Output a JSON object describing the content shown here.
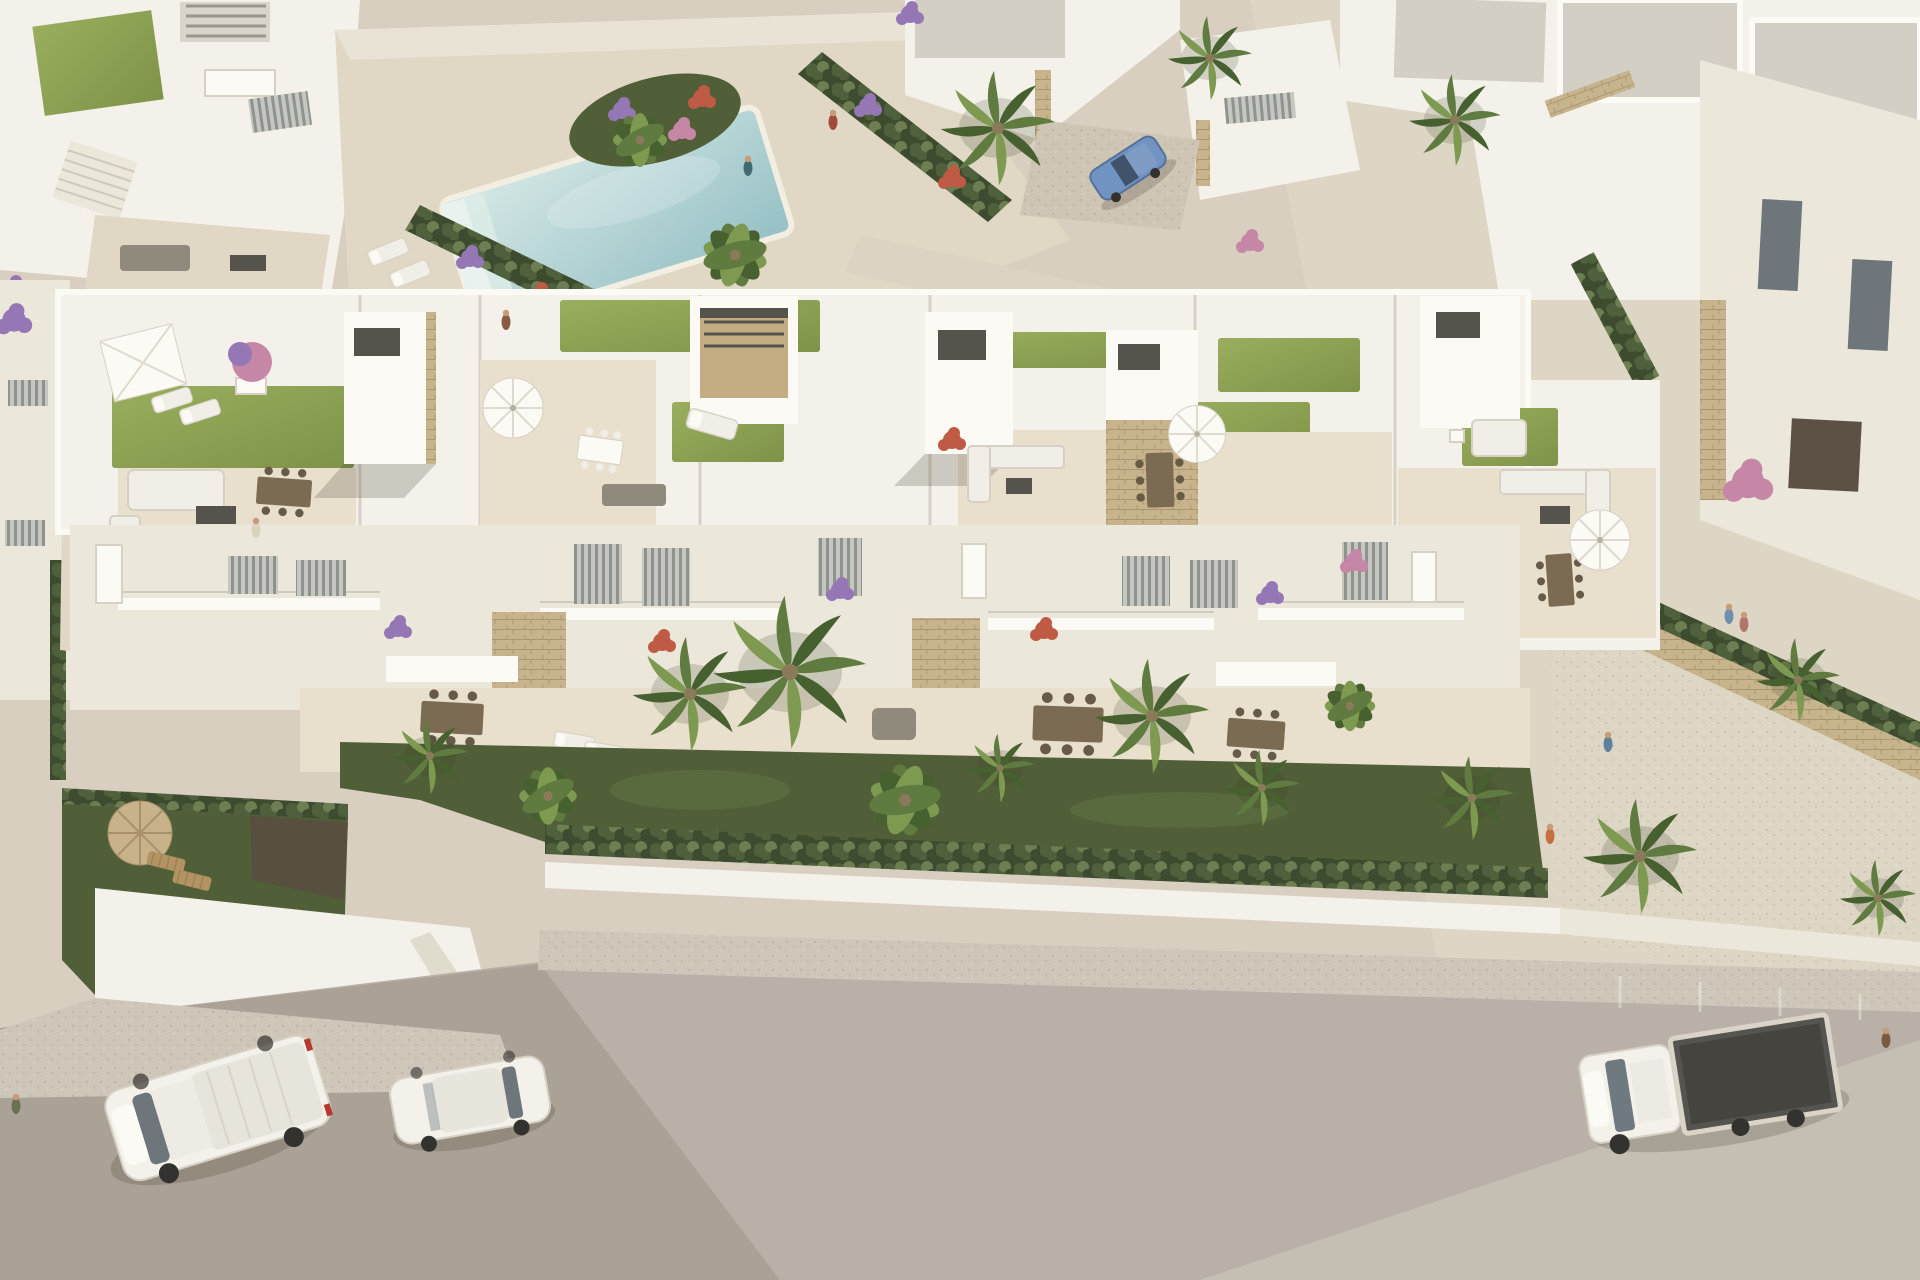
{
  "scene": {
    "title": "Aerial render — white Mediterranean villas with rooftop terraces",
    "description": "Photorealistic CGI bird's-eye view of a new-build residential complex: a long row of white townhouses with landscaped rooftop terraces, private gardens with cypress hedges and palm trees, a communal swimming pool with flower islands among neighbouring villas, and a street in front with parked vehicles.",
    "style": "top-down oblique 3D architectural visualisation, warm afternoon sunlight from upper right, long soft shadows to lower left"
  },
  "palette": {
    "ground": "#d8cfc0",
    "ground-light": "#e7decd",
    "white": "#f3f1e9",
    "white-bright": "#fbfaf4",
    "shade": "#ebe7da",
    "tile": "#e8dfcd",
    "deck": "#e0d7c5",
    "roof": "#d3cfc5",
    "turf1": "#9aae5e",
    "turf2": "#7e9348",
    "lawn": "#6d7f47",
    "lawn-deep": "#515f38",
    "hedge": "#4f603c",
    "hedge-light": "#6d7f52",
    "hedge-dark": "#3d4b2e",
    "palm1": "#5f7b3f",
    "palm2": "#47602f",
    "palm3": "#7d9a50",
    "trunk": "#8b7a5a",
    "pool1": "#d7e9e6",
    "pool2": "#95c0c5",
    "pool-rim": "#f2eee2",
    "road": "#b9b1a7",
    "sidewalk": "#cec6b8",
    "stone": "#c8b48c",
    "stone-dark": "#ab9772",
    "wood": "#b39362",
    "furn": "#8f8a7c",
    "furn-dark": "#55534c",
    "cushion": "#f0eee6",
    "glass": "#6e757b",
    "straw": "#c8b289",
    "straw-dark": "#a8916a",
    "fl-purple": "#9577b5",
    "fl-pink": "#c687a7",
    "fl-red": "#bf5b45",
    "car-blue": "#7093c2",
    "truck-bed": "#555450",
    "gate": "#6b4e32",
    "frame": "#d6d1c4",
    "shadow": "rgba(70,60,45,0.22)"
  },
  "objects": {
    "buildings": [
      "main-townhouse-row-with-rooftop-terraces",
      "top-left-villa-cluster",
      "top-right-villa-cluster",
      "right-neighbour-villa",
      "garden-garage-volume"
    ],
    "amenities": [
      "communal-swimming-pool",
      "rooftop-artificial-lawns",
      "white-parasols",
      "straw-parasols",
      "sun-loungers",
      "outdoor-sofa-sets",
      "dining-sets",
      "pergola",
      "daybed",
      "balconies-with-glass-railing",
      "private-gardens"
    ],
    "vegetation": [
      "fan-palms",
      "banana-plants",
      "cypress-hedges",
      "bougainvillea",
      "flower-beds-purple-pink-red",
      "rooftop-flowering-tree"
    ],
    "vehicles": [
      {
        "name": "white-panel-van",
        "location": "street-left"
      },
      {
        "name": "white-compact-van",
        "location": "street-center-left"
      },
      {
        "name": "white-flatbed-truck",
        "location": "street-right"
      },
      {
        "name": "blue-hatchback",
        "location": "driveway-upper-right"
      }
    ],
    "people_count": 10,
    "street": {
      "road": "asphalt-light-grey",
      "sidewalk": "speckled-pavement",
      "boundary": "low-white-wall-with-hedge"
    }
  }
}
